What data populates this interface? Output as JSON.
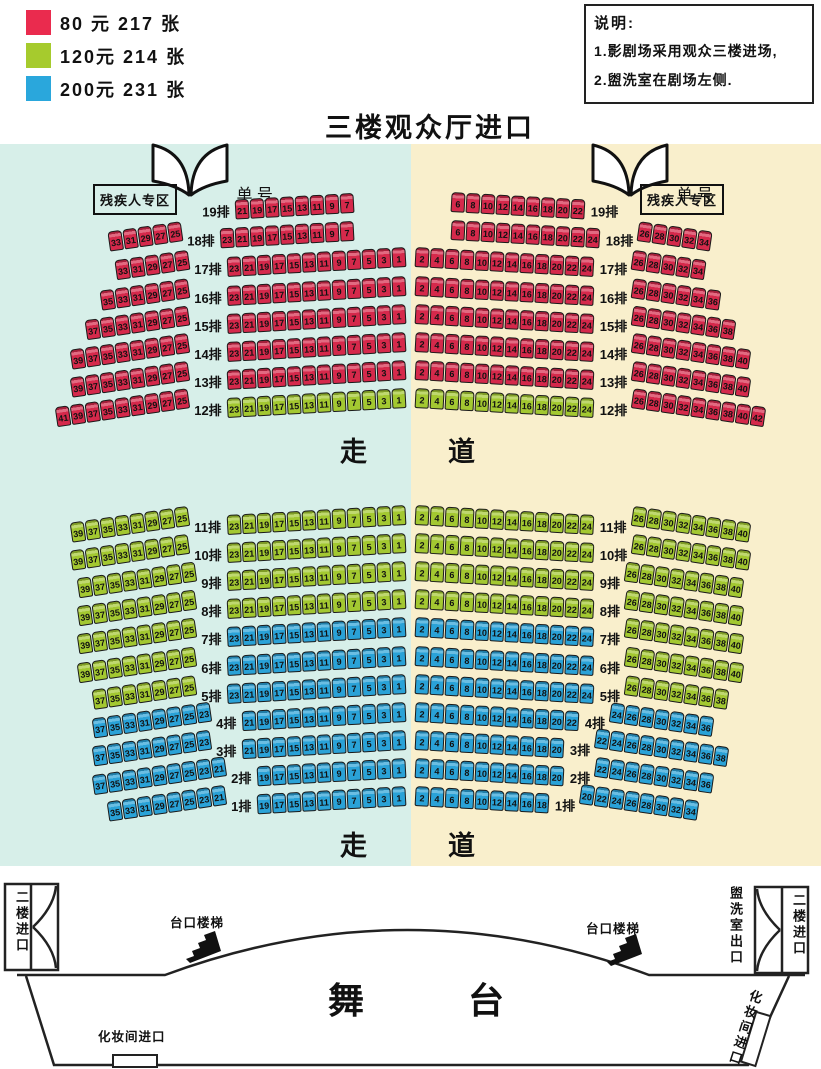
{
  "title": "三楼观众厅进口",
  "colors": {
    "red": "#d5294b",
    "green": "#a3c831",
    "blue": "#2aa2d7",
    "bg_left": "#d7efe9",
    "bg_right": "#f9efcc"
  },
  "legend": {
    "items": [
      {
        "color": "#ea2b4e",
        "label": "80 元 217 张",
        "price": "80元",
        "count": 217
      },
      {
        "color": "#a6cb2d",
        "label": "120元 214 张",
        "price": "120元",
        "count": 214
      },
      {
        "color": "#2aa7dc",
        "label": "200元 231 张",
        "price": "200元",
        "count": 231
      }
    ]
  },
  "note": {
    "title": "说明:",
    "line1": "1.影剧场采用观众三楼进场,",
    "line2": "2.盥洗室在剧场左侧."
  },
  "entrances": {
    "left": {
      "char_left": "单",
      "char_right": "号"
    },
    "right": {
      "char_left": "单",
      "char_right": "号"
    }
  },
  "zones": {
    "disabled_left": "残疾人专区",
    "disabled_right": "残疾人专区"
  },
  "aisles": {
    "top": {
      "c1": "走",
      "c2": "道"
    },
    "bottom": {
      "c1": "走",
      "c2": "道"
    }
  },
  "stage": {
    "char1": "舞",
    "char2": "台",
    "stairs_left": "台口楼梯",
    "stairs_right": "台口楼梯",
    "second_floor_left": "二楼进口",
    "second_floor_right": "二楼进口",
    "washroom_exit": "盥洗室出口",
    "makeup_left": "化妆间进口",
    "makeup_right": "化妆间进口"
  },
  "rows": [
    {
      "label": "19排",
      "y": 189,
      "lo": null,
      "li": {
        "c": "red",
        "s": [
          21,
          19,
          17,
          15,
          13,
          11,
          9,
          7
        ]
      },
      "lp": 46,
      "ri": {
        "c": "red",
        "s": [
          6,
          8,
          10,
          12,
          14,
          16,
          18,
          20,
          22
        ]
      },
      "rp": 30,
      "ro": null
    },
    {
      "label": "18排",
      "y": 217,
      "lo": {
        "c": "red",
        "s": [
          33,
          31,
          29,
          27,
          25
        ]
      },
      "li": {
        "c": "red",
        "s": [
          23,
          21,
          19,
          17,
          15,
          13,
          11,
          9,
          7
        ]
      },
      "lp": 46,
      "ri": {
        "c": "red",
        "s": [
          6,
          8,
          10,
          12,
          14,
          16,
          18,
          20,
          22,
          24
        ]
      },
      "rp": 30,
      "ro": {
        "c": "red",
        "s": [
          26,
          28,
          30,
          32,
          34
        ]
      }
    },
    {
      "label": "17排",
      "y": 246,
      "lo": {
        "c": "red",
        "s": [
          33,
          31,
          29,
          27,
          25
        ]
      },
      "li": {
        "c": "red",
        "s": [
          23,
          21,
          19,
          17,
          15,
          13,
          11,
          9,
          7,
          5,
          3,
          1
        ]
      },
      "lp": 0,
      "ri": {
        "c": "red",
        "s": [
          2,
          4,
          6,
          8,
          10,
          12,
          14,
          16,
          18,
          20,
          22,
          24
        ]
      },
      "rp": 0,
      "ro": {
        "c": "red",
        "s": [
          26,
          28,
          30,
          32,
          34
        ]
      }
    },
    {
      "label": "16排",
      "y": 275,
      "lo": {
        "c": "red",
        "s": [
          35,
          33,
          31,
          29,
          27,
          25
        ]
      },
      "li": {
        "c": "red",
        "s": [
          23,
          21,
          19,
          17,
          15,
          13,
          11,
          9,
          7,
          5,
          3,
          1
        ]
      },
      "lp": 0,
      "ri": {
        "c": "red",
        "s": [
          2,
          4,
          6,
          8,
          10,
          12,
          14,
          16,
          18,
          20,
          22,
          24
        ]
      },
      "rp": 0,
      "ro": {
        "c": "red",
        "s": [
          26,
          28,
          30,
          32,
          34,
          36
        ]
      }
    },
    {
      "label": "15排",
      "y": 303,
      "lo": {
        "c": "red",
        "s": [
          37,
          35,
          33,
          31,
          29,
          27,
          25
        ]
      },
      "li": {
        "c": "red",
        "s": [
          23,
          21,
          19,
          17,
          15,
          13,
          11,
          9,
          7,
          5,
          3,
          1
        ]
      },
      "lp": 0,
      "ri": {
        "c": "red",
        "s": [
          2,
          4,
          6,
          8,
          10,
          12,
          14,
          16,
          18,
          20,
          22,
          24
        ]
      },
      "rp": 0,
      "ro": {
        "c": "red",
        "s": [
          26,
          28,
          30,
          32,
          34,
          36,
          38
        ]
      }
    },
    {
      "label": "14排",
      "y": 331,
      "lo": {
        "c": "red",
        "s": [
          39,
          37,
          35,
          33,
          31,
          29,
          27,
          25
        ]
      },
      "li": {
        "c": "red",
        "s": [
          23,
          21,
          19,
          17,
          15,
          13,
          11,
          9,
          7,
          5,
          3,
          1
        ]
      },
      "lp": 0,
      "ri": {
        "c": "red",
        "s": [
          2,
          4,
          6,
          8,
          10,
          12,
          14,
          16,
          18,
          20,
          22,
          24
        ]
      },
      "rp": 0,
      "ro": {
        "c": "red",
        "s": [
          26,
          28,
          30,
          32,
          34,
          36,
          38,
          40
        ]
      }
    },
    {
      "label": "13排",
      "y": 359,
      "lo": {
        "c": "red",
        "s": [
          39,
          37,
          35,
          33,
          31,
          29,
          27,
          25
        ]
      },
      "li": {
        "c": "red",
        "s": [
          23,
          21,
          19,
          17,
          15,
          13,
          11,
          9,
          7,
          5,
          3,
          1
        ]
      },
      "lp": 0,
      "ri": {
        "c": "red",
        "s": [
          2,
          4,
          6,
          8,
          10,
          12,
          14,
          16,
          18,
          20,
          22,
          24
        ]
      },
      "rp": 0,
      "ro": {
        "c": "red",
        "s": [
          26,
          28,
          30,
          32,
          34,
          36,
          38,
          40
        ]
      }
    },
    {
      "label": "12排",
      "y": 387,
      "lo": {
        "c": "red",
        "s": [
          41,
          39,
          37,
          35,
          33,
          31,
          29,
          27,
          25
        ]
      },
      "li": {
        "c": "green",
        "s": [
          23,
          21,
          19,
          17,
          15,
          13,
          11,
          9,
          7,
          5,
          3,
          1
        ]
      },
      "lp": 0,
      "ri": {
        "c": "green",
        "s": [
          2,
          4,
          6,
          8,
          10,
          12,
          14,
          16,
          18,
          20,
          22,
          24
        ]
      },
      "rp": 0,
      "ro": {
        "c": "red",
        "s": [
          26,
          28,
          30,
          32,
          34,
          36,
          38,
          40,
          42
        ]
      }
    },
    {
      "label": "11排",
      "y": 504,
      "lo": {
        "c": "green",
        "s": [
          39,
          37,
          35,
          33,
          31,
          29,
          27,
          25
        ]
      },
      "li": {
        "c": "green",
        "s": [
          23,
          21,
          19,
          17,
          15,
          13,
          11,
          9,
          7,
          5,
          3,
          1
        ]
      },
      "lp": 0,
      "ri": {
        "c": "green",
        "s": [
          2,
          4,
          6,
          8,
          10,
          12,
          14,
          16,
          18,
          20,
          22,
          24
        ]
      },
      "rp": 0,
      "ro": {
        "c": "green",
        "s": [
          26,
          28,
          30,
          32,
          34,
          36,
          38,
          40
        ]
      }
    },
    {
      "label": "10排",
      "y": 532,
      "lo": {
        "c": "green",
        "s": [
          39,
          37,
          35,
          33,
          31,
          29,
          27,
          25
        ]
      },
      "li": {
        "c": "green",
        "s": [
          23,
          21,
          19,
          17,
          15,
          13,
          11,
          9,
          7,
          5,
          3,
          1
        ]
      },
      "lp": 0,
      "ri": {
        "c": "green",
        "s": [
          2,
          4,
          6,
          8,
          10,
          12,
          14,
          16,
          18,
          20,
          22,
          24
        ]
      },
      "rp": 0,
      "ro": {
        "c": "green",
        "s": [
          26,
          28,
          30,
          32,
          34,
          36,
          38,
          40
        ]
      }
    },
    {
      "label": "9排",
      "y": 560,
      "lo": {
        "c": "green",
        "s": [
          39,
          37,
          35,
          33,
          31,
          29,
          27,
          25
        ]
      },
      "li": {
        "c": "green",
        "s": [
          23,
          21,
          19,
          17,
          15,
          13,
          11,
          9,
          7,
          5,
          3,
          1
        ]
      },
      "lp": 0,
      "ri": {
        "c": "green",
        "s": [
          2,
          4,
          6,
          8,
          10,
          12,
          14,
          16,
          18,
          20,
          22,
          24
        ]
      },
      "rp": 0,
      "ro": {
        "c": "green",
        "s": [
          26,
          28,
          30,
          32,
          34,
          36,
          38,
          40
        ]
      }
    },
    {
      "label": "8排",
      "y": 588,
      "lo": {
        "c": "green",
        "s": [
          39,
          37,
          35,
          33,
          31,
          29,
          27,
          25
        ]
      },
      "li": {
        "c": "green",
        "s": [
          23,
          21,
          19,
          17,
          15,
          13,
          11,
          9,
          7,
          5,
          3,
          1
        ]
      },
      "lp": 0,
      "ri": {
        "c": "green",
        "s": [
          2,
          4,
          6,
          8,
          10,
          12,
          14,
          16,
          18,
          20,
          22,
          24
        ]
      },
      "rp": 0,
      "ro": {
        "c": "green",
        "s": [
          26,
          28,
          30,
          32,
          34,
          36,
          38,
          40
        ]
      }
    },
    {
      "label": "7排",
      "y": 616,
      "lo": {
        "c": "green",
        "s": [
          39,
          37,
          35,
          33,
          31,
          29,
          27,
          25
        ]
      },
      "li": {
        "c": "blue",
        "s": [
          23,
          21,
          19,
          17,
          15,
          13,
          11,
          9,
          7,
          5,
          3,
          1
        ]
      },
      "lp": 0,
      "ri": {
        "c": "blue",
        "s": [
          2,
          4,
          6,
          8,
          10,
          12,
          14,
          16,
          18,
          20,
          22,
          24
        ]
      },
      "rp": 0,
      "ro": {
        "c": "green",
        "s": [
          26,
          28,
          30,
          32,
          34,
          36,
          38,
          40
        ]
      }
    },
    {
      "label": "6排",
      "y": 645,
      "lo": {
        "c": "green",
        "s": [
          39,
          37,
          35,
          33,
          31,
          29,
          27,
          25
        ]
      },
      "li": {
        "c": "blue",
        "s": [
          23,
          21,
          19,
          17,
          15,
          13,
          11,
          9,
          7,
          5,
          3,
          1
        ]
      },
      "lp": 0,
      "ri": {
        "c": "blue",
        "s": [
          2,
          4,
          6,
          8,
          10,
          12,
          14,
          16,
          18,
          20,
          22,
          24
        ]
      },
      "rp": 0,
      "ro": {
        "c": "green",
        "s": [
          26,
          28,
          30,
          32,
          34,
          36,
          38,
          40
        ]
      }
    },
    {
      "label": "5排",
      "y": 673,
      "lo": {
        "c": "green",
        "s": [
          37,
          35,
          33,
          31,
          29,
          27,
          25
        ]
      },
      "li": {
        "c": "blue",
        "s": [
          23,
          21,
          19,
          17,
          15,
          13,
          11,
          9,
          7,
          5,
          3,
          1
        ]
      },
      "lp": 0,
      "ri": {
        "c": "blue",
        "s": [
          2,
          4,
          6,
          8,
          10,
          12,
          14,
          16,
          18,
          20,
          22,
          24
        ]
      },
      "rp": 0,
      "ro": {
        "c": "green",
        "s": [
          26,
          28,
          30,
          32,
          34,
          36,
          38
        ]
      }
    },
    {
      "label": "4排",
      "y": 701,
      "lo": {
        "c": "blue",
        "s": [
          37,
          35,
          33,
          31,
          29,
          27,
          25,
          23
        ]
      },
      "li": {
        "c": "blue",
        "s": [
          21,
          19,
          17,
          15,
          13,
          11,
          9,
          7,
          5,
          3,
          1
        ]
      },
      "lp": 0,
      "ri": {
        "c": "blue",
        "s": [
          2,
          4,
          6,
          8,
          10,
          12,
          14,
          16,
          18,
          20,
          22
        ]
      },
      "rp": 0,
      "ro": {
        "c": "blue",
        "s": [
          24,
          26,
          28,
          30,
          32,
          34,
          36
        ]
      }
    },
    {
      "label": "3排",
      "y": 729,
      "lo": {
        "c": "blue",
        "s": [
          37,
          35,
          33,
          31,
          29,
          27,
          25,
          23
        ]
      },
      "li": {
        "c": "blue",
        "s": [
          21,
          19,
          17,
          15,
          13,
          11,
          9,
          7,
          5,
          3,
          1
        ]
      },
      "lp": 0,
      "ri": {
        "c": "blue",
        "s": [
          2,
          4,
          6,
          8,
          10,
          12,
          14,
          16,
          18,
          20
        ]
      },
      "rp": 0,
      "ro": {
        "c": "blue",
        "s": [
          22,
          24,
          26,
          28,
          30,
          32,
          34,
          36,
          38
        ]
      }
    },
    {
      "label": "2排",
      "y": 757,
      "lo": {
        "c": "blue",
        "s": [
          37,
          35,
          33,
          31,
          29,
          27,
          25,
          23,
          21
        ]
      },
      "li": {
        "c": "blue",
        "s": [
          19,
          17,
          15,
          13,
          11,
          9,
          7,
          5,
          3,
          1
        ]
      },
      "lp": 0,
      "ri": {
        "c": "blue",
        "s": [
          2,
          4,
          6,
          8,
          10,
          12,
          14,
          16,
          18,
          20
        ]
      },
      "rp": 0,
      "ro": {
        "c": "blue",
        "s": [
          22,
          24,
          26,
          28,
          30,
          32,
          34,
          36
        ]
      }
    },
    {
      "label": "1排",
      "y": 785,
      "lo": {
        "c": "blue",
        "s": [
          35,
          33,
          31,
          29,
          27,
          25,
          23,
          21
        ]
      },
      "li": {
        "c": "blue",
        "s": [
          19,
          17,
          15,
          13,
          11,
          9,
          7,
          5,
          3,
          1
        ]
      },
      "lp": 0,
      "ri": {
        "c": "blue",
        "s": [
          2,
          4,
          6,
          8,
          10,
          12,
          14,
          16,
          18
        ]
      },
      "rp": 0,
      "ro": {
        "c": "blue",
        "s": [
          20,
          22,
          24,
          26,
          28,
          30,
          32,
          34
        ]
      }
    }
  ]
}
